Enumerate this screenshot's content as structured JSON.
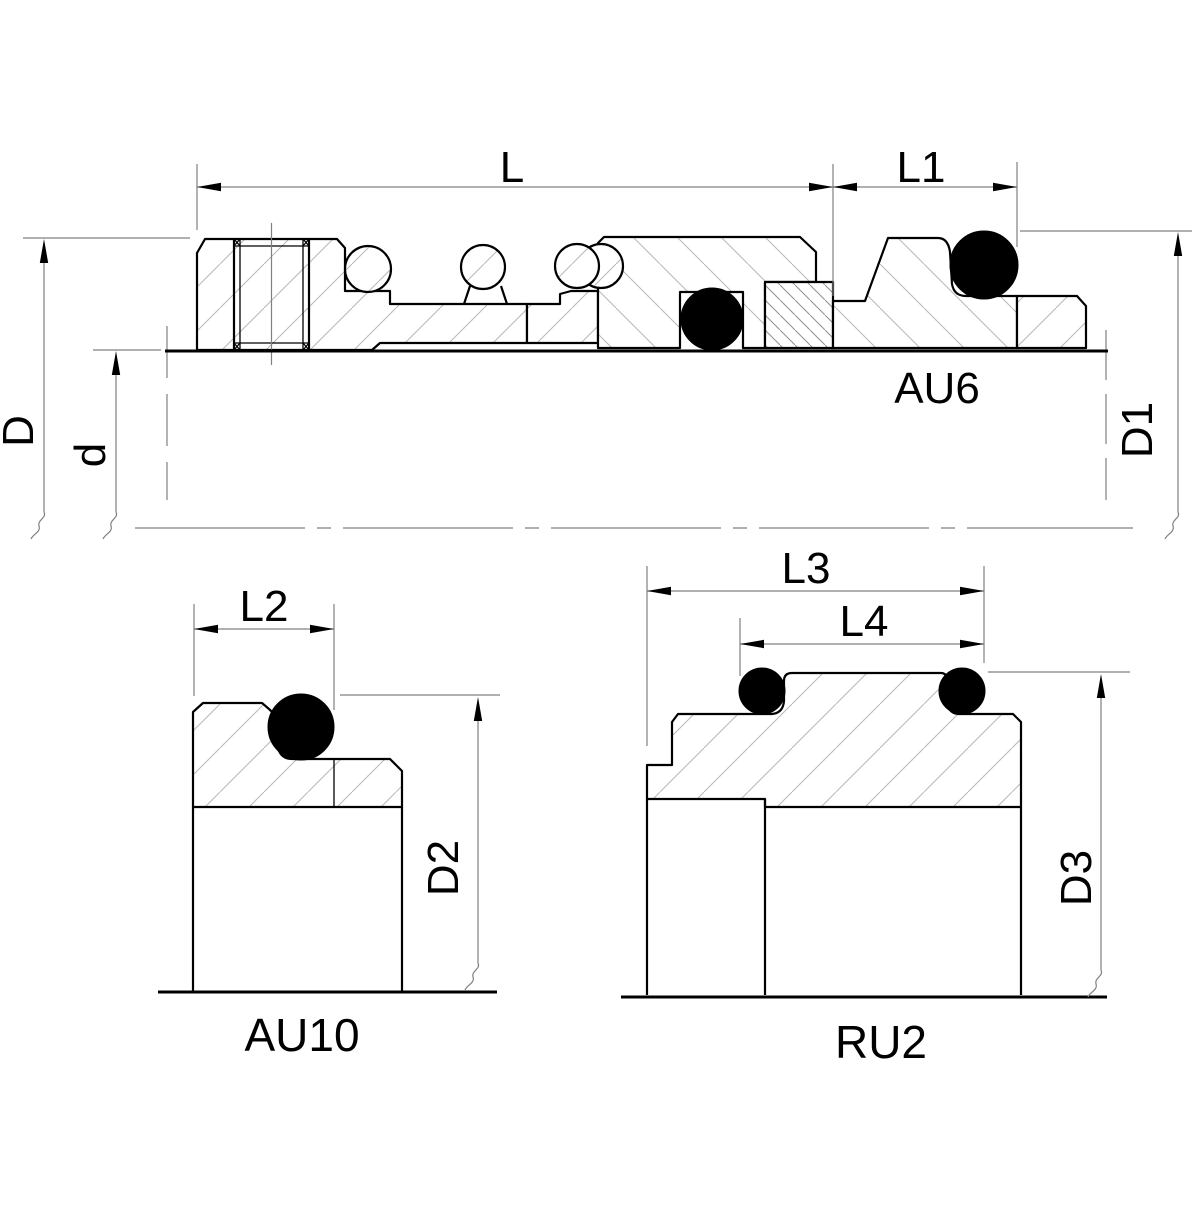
{
  "title": "Seal assembly section drawing",
  "views": {
    "assembly": {
      "label": "AU6",
      "dims": {
        "l": "L",
        "l1": "L1",
        "D": "D",
        "d": "d",
        "d1": "D1"
      }
    },
    "au10": {
      "label": "AU10",
      "dims": {
        "l2": "L2",
        "d2": "D2"
      }
    },
    "ru2": {
      "label": "RU2",
      "dims": {
        "l3": "L3",
        "l4": "L4",
        "d3": "D3"
      }
    }
  },
  "colors": {
    "line": "#000000",
    "dim_line": "#808080",
    "hatch": "#b8b8b8",
    "hatch_dense": "#8f8f8f",
    "oring": "#000000",
    "background": "#ffffff"
  }
}
